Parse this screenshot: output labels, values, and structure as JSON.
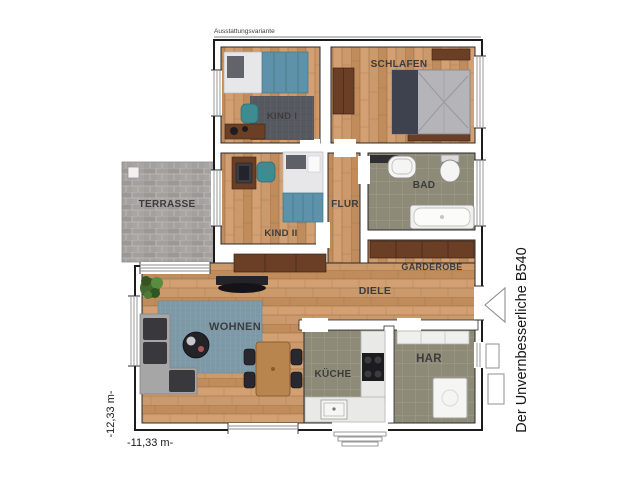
{
  "meta": {
    "variant_label": "Ausstattungsvariante",
    "plan_title": "Der Unvernbesserliche B540"
  },
  "dimensions": {
    "width_label": "-11,33 m-",
    "height_label": "-12,33 m-"
  },
  "rooms": {
    "kind1": "KIND I",
    "schlafen": "SCHLAFEN",
    "kind2": "KIND II",
    "flur": "FLUR",
    "bad": "BAD",
    "terrasse": "TERRASSE",
    "garderobe": "GARDEROBE",
    "diele": "DIELE",
    "wohnen": "WOHNEN",
    "kueche": "KÜCHE",
    "har": "HAR"
  },
  "colors": {
    "wall": "#ffffff",
    "outline": "#1c1c1c",
    "wood_floor": "#c89565",
    "tile_floor": "#8e8a78",
    "terrace_stone": "#a19e9b",
    "rug_blue": "#7e9aa8",
    "rug_dark": "#565a60",
    "furniture_wood": "#6a3f26",
    "dining_wood": "#b9854f",
    "bed_teal": "#5d92aa",
    "sofa_gray": "#a6a6a6",
    "cushion_dark": "#39393d",
    "label_text": "#3c3c3c"
  }
}
